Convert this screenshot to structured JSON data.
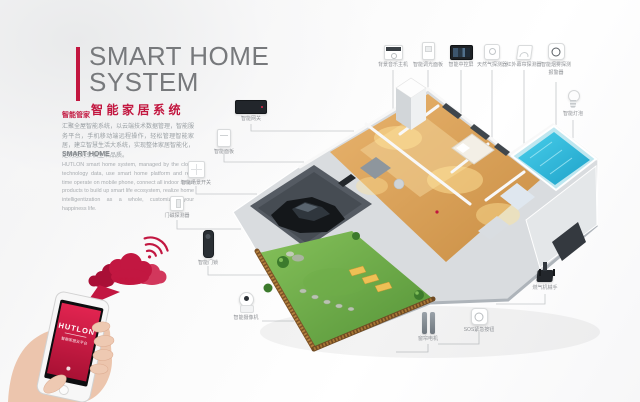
{
  "title": {
    "line1": "SMART HOME",
    "line2": "SYSTEM",
    "subtitle": "智能家居系统"
  },
  "intro_cn": {
    "heading": "智能管家",
    "body": "汇聚全屋智能系统，以云端技术数据管理，智能服务平台，手机移动端远程操作，轻松管理智能家居，建立智慧生活大系统，实现整体家居智能化，定制您的幸福生活品质。"
  },
  "intro_en": {
    "heading": "SMART HOME",
    "body": "HUTLON smart home system, managed by the cloud technology data, use smart home platform and real time operate on mobile phone, connect all indoor smart products to build up smart life ecosystem, realize home intelligentization as a whole, customized your happiness life."
  },
  "cloud": {
    "label": "云端数据库"
  },
  "phone": {
    "brand": "HUTLON",
    "tagline": "智能家居云平台"
  },
  "devices": {
    "top": [
      {
        "label": "背景音乐主机",
        "icon": "music-host-icon"
      },
      {
        "label": "智能调光面板",
        "icon": "dimmer-panel-icon"
      },
      {
        "label": "智能中控屏",
        "icon": "control-screen-icon"
      },
      {
        "label": "天然气探测器",
        "icon": "gas-detector-icon"
      },
      {
        "label": "红外幕帘探测器",
        "icon": "pir-detector-icon"
      },
      {
        "label": "智能烟雾探测",
        "label2": "报警器",
        "icon": "smoke-detector-icon"
      }
    ],
    "left": [
      {
        "label": "智能网关",
        "icon": "gateway-icon"
      },
      {
        "label": "智能面板",
        "icon": "wall-panel-icon"
      },
      {
        "label": "智能场景开关",
        "icon": "scene-switch-icon"
      },
      {
        "label": "门磁探测器",
        "icon": "door-sensor-icon"
      },
      {
        "label": "智能门锁",
        "icon": "door-lock-icon"
      },
      {
        "label": "智能摄像机",
        "icon": "camera-icon"
      }
    ],
    "bottom": [
      {
        "label": "窗帘电机",
        "icon": "curtain-motor-icon"
      },
      {
        "label": "SOS紧急按钮",
        "icon": "sos-button-icon"
      },
      {
        "label": "燃气机械手",
        "icon": "gas-valve-icon"
      }
    ],
    "right": [
      {
        "label": "智能灯泡",
        "icon": "bulb-icon"
      }
    ]
  },
  "colors": {
    "accent": "#c2163f",
    "line": "#c3c6c9",
    "title_gray": "#77797c"
  }
}
